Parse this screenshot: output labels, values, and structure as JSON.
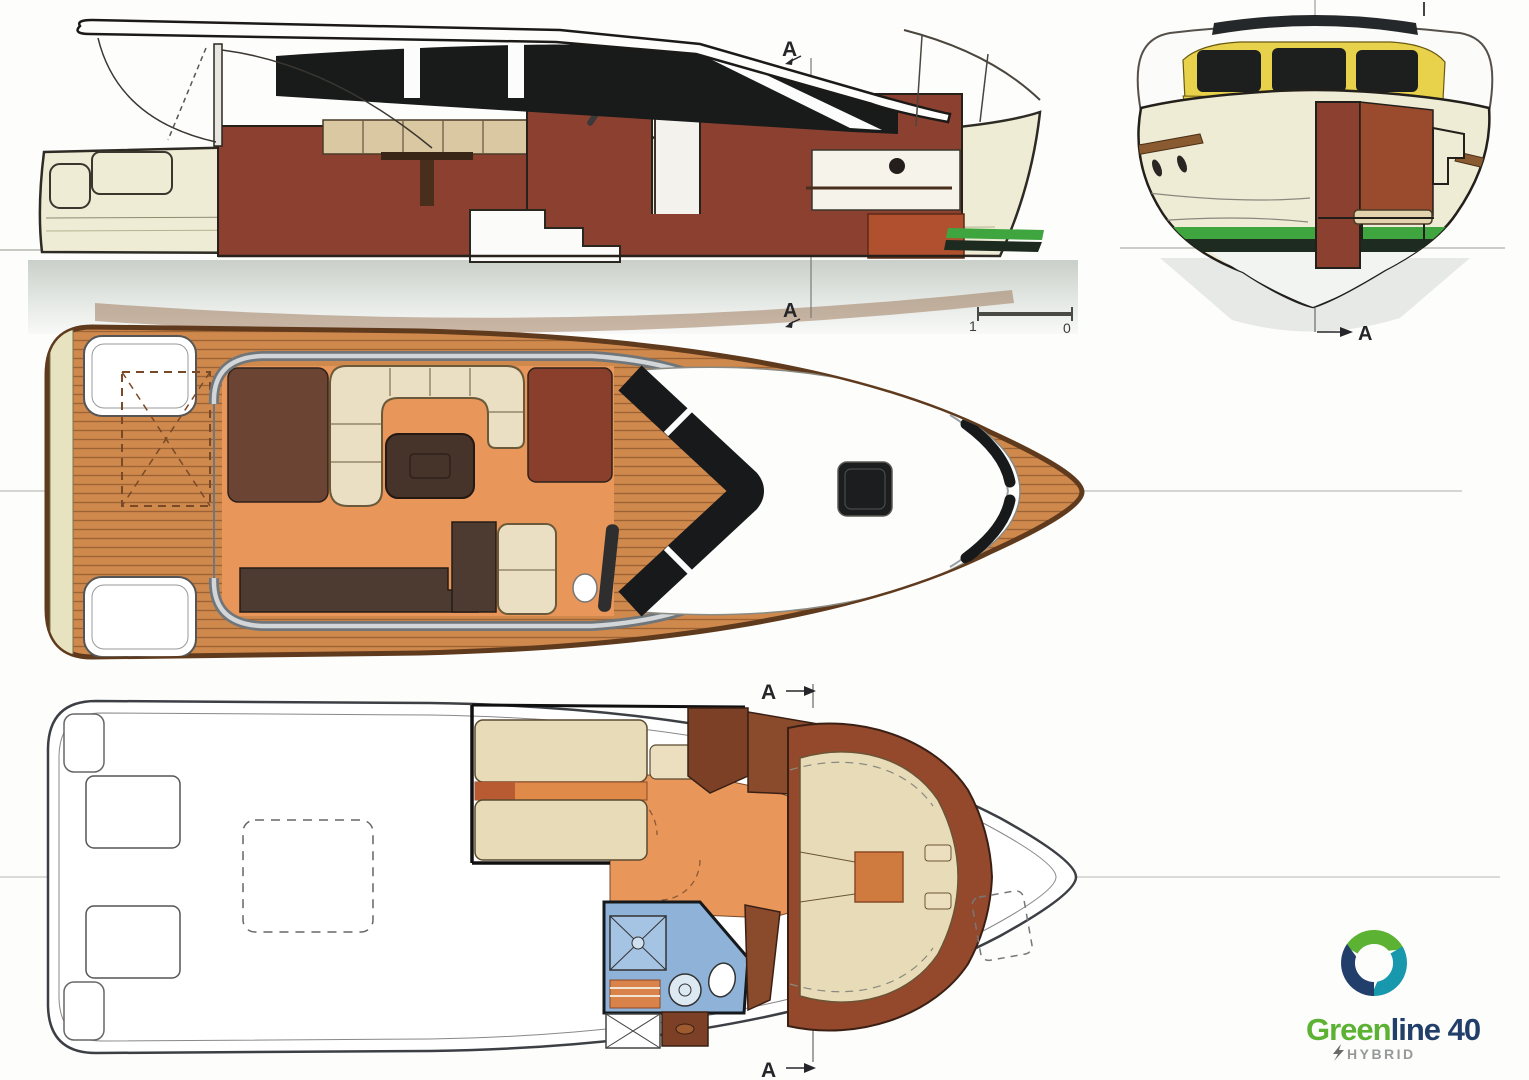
{
  "document": {
    "kind": "boat-general-arrangement-plans",
    "views": {
      "side": "side-elevation-cutaway",
      "bow": "bow-cross-section",
      "main_deck": "main-deck-plan",
      "lower_deck": "lower-deck-plan"
    }
  },
  "annotations": {
    "side_top": "A",
    "side_bottom": "A",
    "bow_view": "A",
    "lower_top": "A",
    "lower_bottom": "A",
    "scale": {
      "left": "1",
      "right": "0"
    }
  },
  "logo": {
    "brand_green": "Green",
    "brand_rest": "line 40",
    "tagline": "HYBRID",
    "colors": {
      "green": "#5cb232",
      "teal": "#1898ad",
      "navy": "#223f6b",
      "tagline_gray": "#96989a"
    }
  },
  "palette": {
    "teak_deck": "#d0894d",
    "hull_cream": "#efecd6",
    "interior_maroon": "#8c4130",
    "interior_brown": "#6b4434",
    "upholstery_beige": "#eadfc2",
    "floor_orange": "#e8965a",
    "bathroom_blue": "#8fb3d8",
    "stripe_green": "#3fa63f",
    "window_black": "#17191a",
    "frame_yellow": "#e8d24b"
  }
}
